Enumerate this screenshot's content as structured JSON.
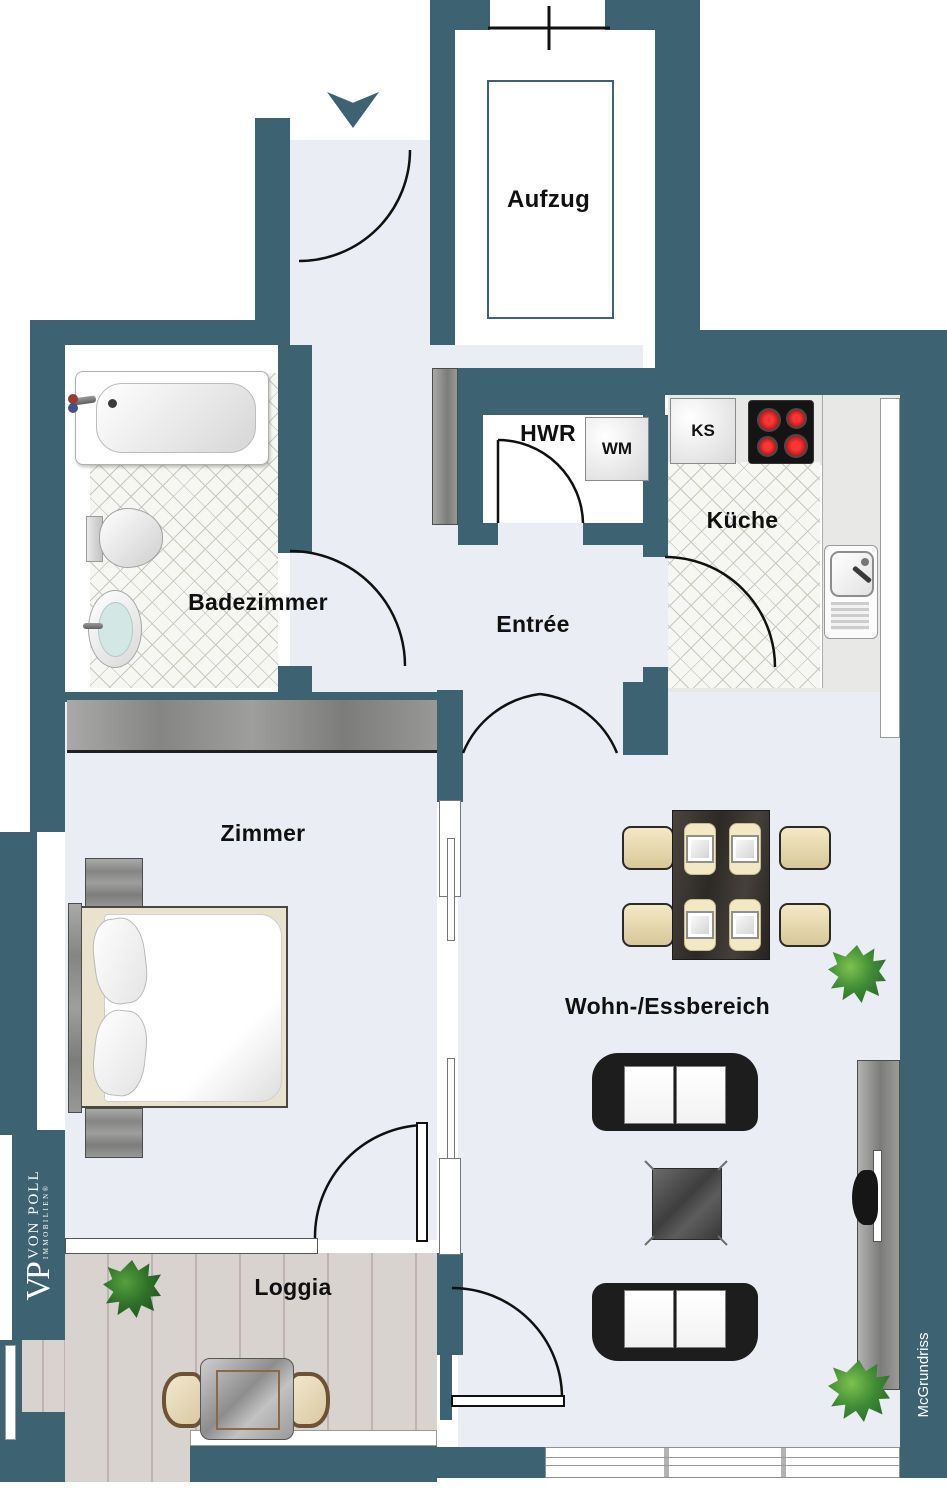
{
  "plan_title": "apartment-floor-plan",
  "rooms": {
    "aufzug": {
      "label": "Aufzug"
    },
    "hwr": {
      "label": "HWR"
    },
    "kueche": {
      "label": "Küche"
    },
    "badezimmer": {
      "label": "Badezimmer"
    },
    "entree": {
      "label": "Entrée"
    },
    "zimmer": {
      "label": "Zimmer"
    },
    "wohnbereich": {
      "label": "Wohn-/Essbereich"
    },
    "loggia": {
      "label": "Loggia"
    }
  },
  "appliances": {
    "wm": {
      "label": "WM"
    },
    "ks": {
      "label": "KS"
    }
  },
  "branding": {
    "vp_initials": "VP",
    "vp_name": "VON POLL",
    "vp_sub": "IMMOBILIEN®",
    "credit": "McGrundriss"
  },
  "colors": {
    "wall": "#3d6373",
    "floor": "#eaedf3",
    "tile_line": "#c8c8c3",
    "deck": "#d9d3d0",
    "burner_red": "#cc1111",
    "plant_green": "#3f8a35",
    "furniture_dark": "#1d1d1d",
    "chair_cream": "#e9dcb4"
  }
}
